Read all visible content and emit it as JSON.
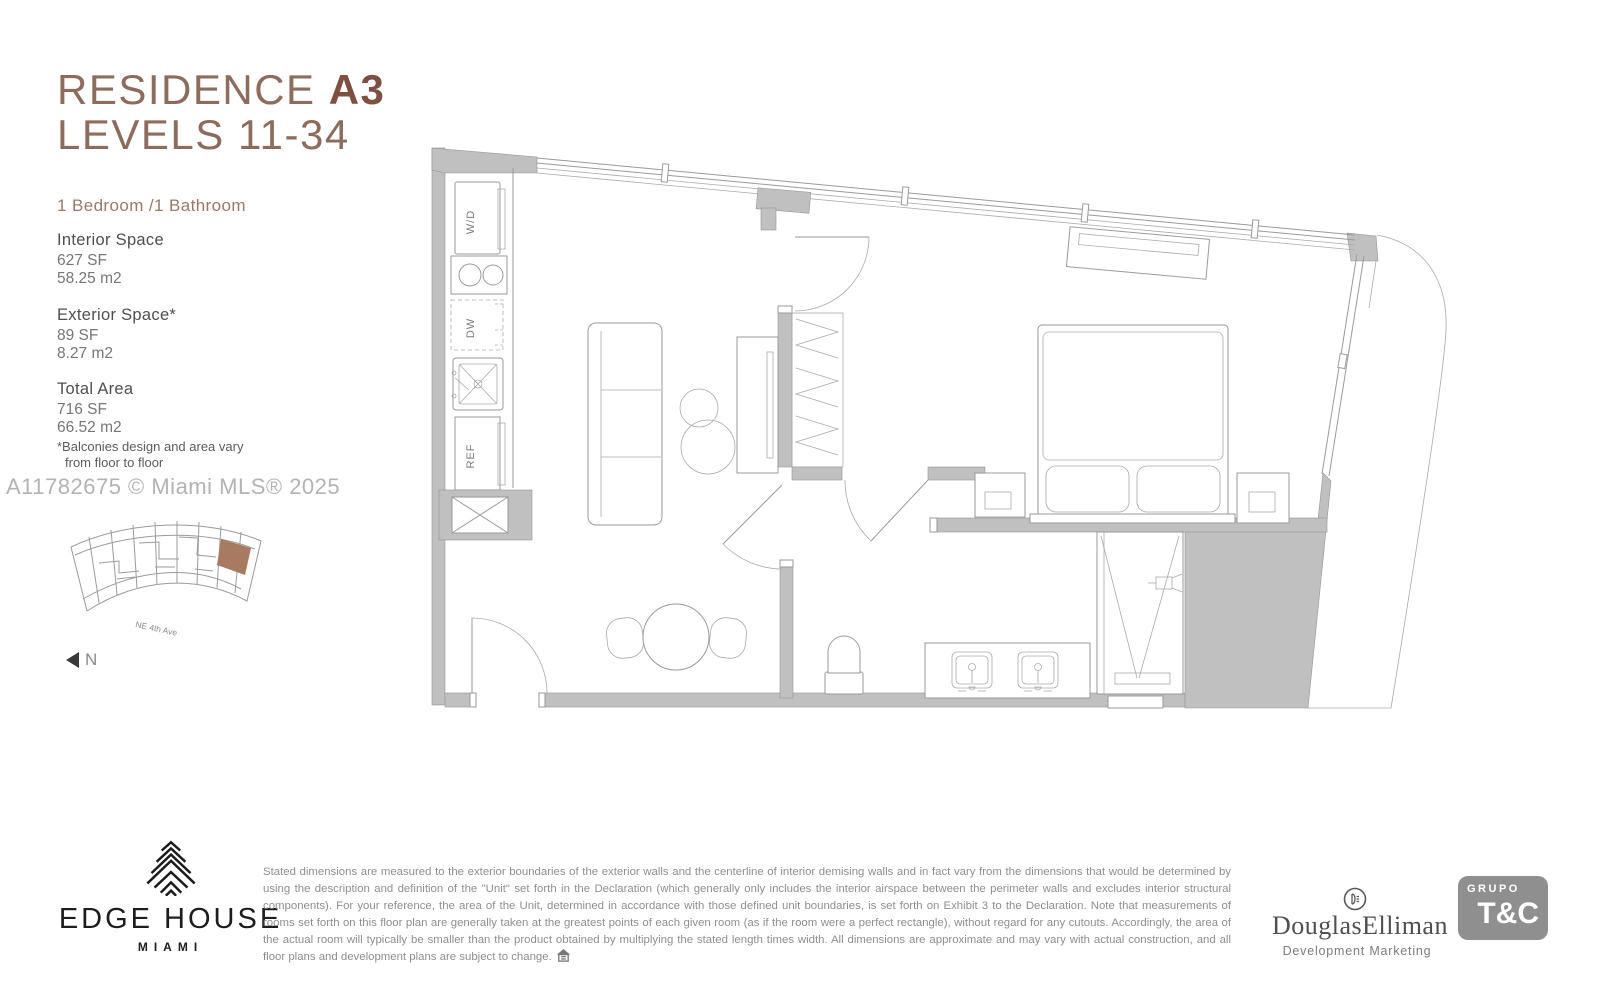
{
  "header": {
    "title_regular": "RESIDENCE ",
    "title_bold": "A3",
    "title_line2": "LEVELS 11-34",
    "config": "1 Bedroom /1 Bathroom"
  },
  "stats": [
    {
      "label": "Interior Space",
      "sf": "627 SF",
      "m2": "58.25 m2"
    },
    {
      "label": "Exterior Space*",
      "sf": "89 SF",
      "m2": "8.27 m2"
    },
    {
      "label": "Total Area",
      "sf": "716 SF",
      "m2": "66.52 m2"
    }
  ],
  "footnote": {
    "line1": "*Balconies design and area vary",
    "line2": "from floor to floor"
  },
  "watermark": "A11782675 © Miami MLS® 2025",
  "keyplan": {
    "street": "NE 4th Ave",
    "north_label": "N",
    "highlight_color": "#a87a62"
  },
  "floorplan_labels": {
    "washer_dryer": "W/D",
    "dishwasher": "DW",
    "refrigerator": "REF"
  },
  "footer": {
    "edge_house": "EDGE HOUSE",
    "city": "MIAMI",
    "disclaimer": "Stated dimensions are measured to the exterior boundaries of the exterior walls and the centerline of interior demising walls and in fact vary from the dimensions that would be determined by using the description and definition of the \"Unit\" set forth in the Declaration (which generally only includes the interior airspace between the perimeter walls and excludes interior structural components).  For your reference, the area of the Unit, determined in accordance with those defined unit boundaries, is set forth on Exhibit 3 to the Declaration.  Note that measurements of rooms set forth on this floor plan are generally taken at the greatest points of each given room (as if the room were a perfect rectangle), without regard for any cutouts.  Accordingly, the area of the actual room will typically be smaller than the product obtained by multiplying the stated length times width.  All dimensions are approximate and may vary with actual construction, and all floor plans and development plans are subject to change.",
    "douglas_elliman": "DouglasElliman",
    "de_subtitle": "Development Marketing",
    "grupo": "GRUPO",
    "tc": "T&C"
  },
  "colors": {
    "accent_brown": "#8d6c5d",
    "accent_brown_dark": "#7d5042",
    "keyplan_highlight": "#a87a62",
    "wall_gray": "#c1c0c0",
    "text_gray": "#4f4f4f"
  }
}
